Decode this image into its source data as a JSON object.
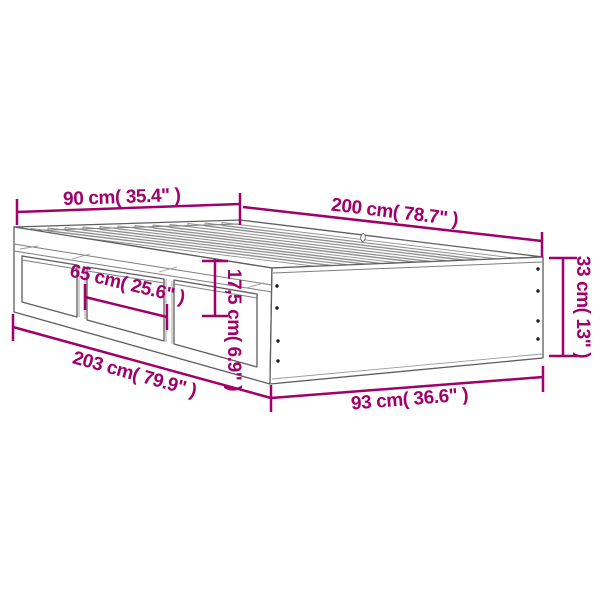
{
  "diagram": {
    "type": "product-dimension-diagram",
    "subject": "bed-frame-with-drawers",
    "colors": {
      "dimension_accent": "#a1006b",
      "frame_outline": "#5e5e5e",
      "slat_line": "#8f8f8f",
      "screw_dot": "#1a1a1a",
      "background": "#ffffff"
    },
    "hole_marker": "0"
  },
  "dimensions": [
    {
      "id": "head-width",
      "cm": "90",
      "inch": "35.4",
      "label": "90 cm( 35.4\" )"
    },
    {
      "id": "side-length",
      "cm": "200",
      "inch": "78.7",
      "label": "200 cm( 78.7\" )"
    },
    {
      "id": "frame-height",
      "cm": "33",
      "inch": "13",
      "label": "33 cm( 13\" )"
    },
    {
      "id": "drawer-width",
      "cm": "65",
      "inch": "25.6",
      "label": "65 cm( 25.6\" )"
    },
    {
      "id": "drawer-height",
      "cm": "17,5",
      "inch": "6.9",
      "label": "17,5 cm( 6.9\" )"
    },
    {
      "id": "total-length",
      "cm": "203",
      "inch": "79.9",
      "label": "203 cm( 79.9\" )"
    },
    {
      "id": "foot-width",
      "cm": "93",
      "inch": "36.6",
      "label": "93 cm( 36.6\" )"
    }
  ]
}
